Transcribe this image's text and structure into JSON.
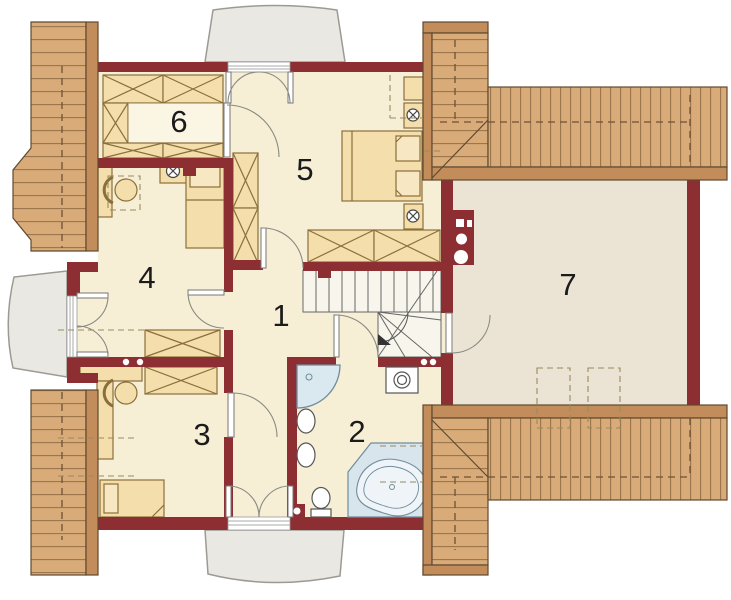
{
  "plan": {
    "type": "floor-plan",
    "rooms": [
      {
        "label": "1"
      },
      {
        "label": "2"
      },
      {
        "label": "3"
      },
      {
        "label": "4"
      },
      {
        "label": "5"
      },
      {
        "label": "6"
      },
      {
        "label": "7"
      }
    ],
    "palette": {
      "wall": "#8d2e33",
      "floor": "#f6efd6",
      "attic_floor": "#ebe4d5",
      "furniture": "#f4deac",
      "roof_wood": "#d9ab79",
      "roof_fascia": "#c28d5a",
      "fixture_blue": "#dae8ef",
      "dormer_gray": "#eae8e2"
    }
  }
}
